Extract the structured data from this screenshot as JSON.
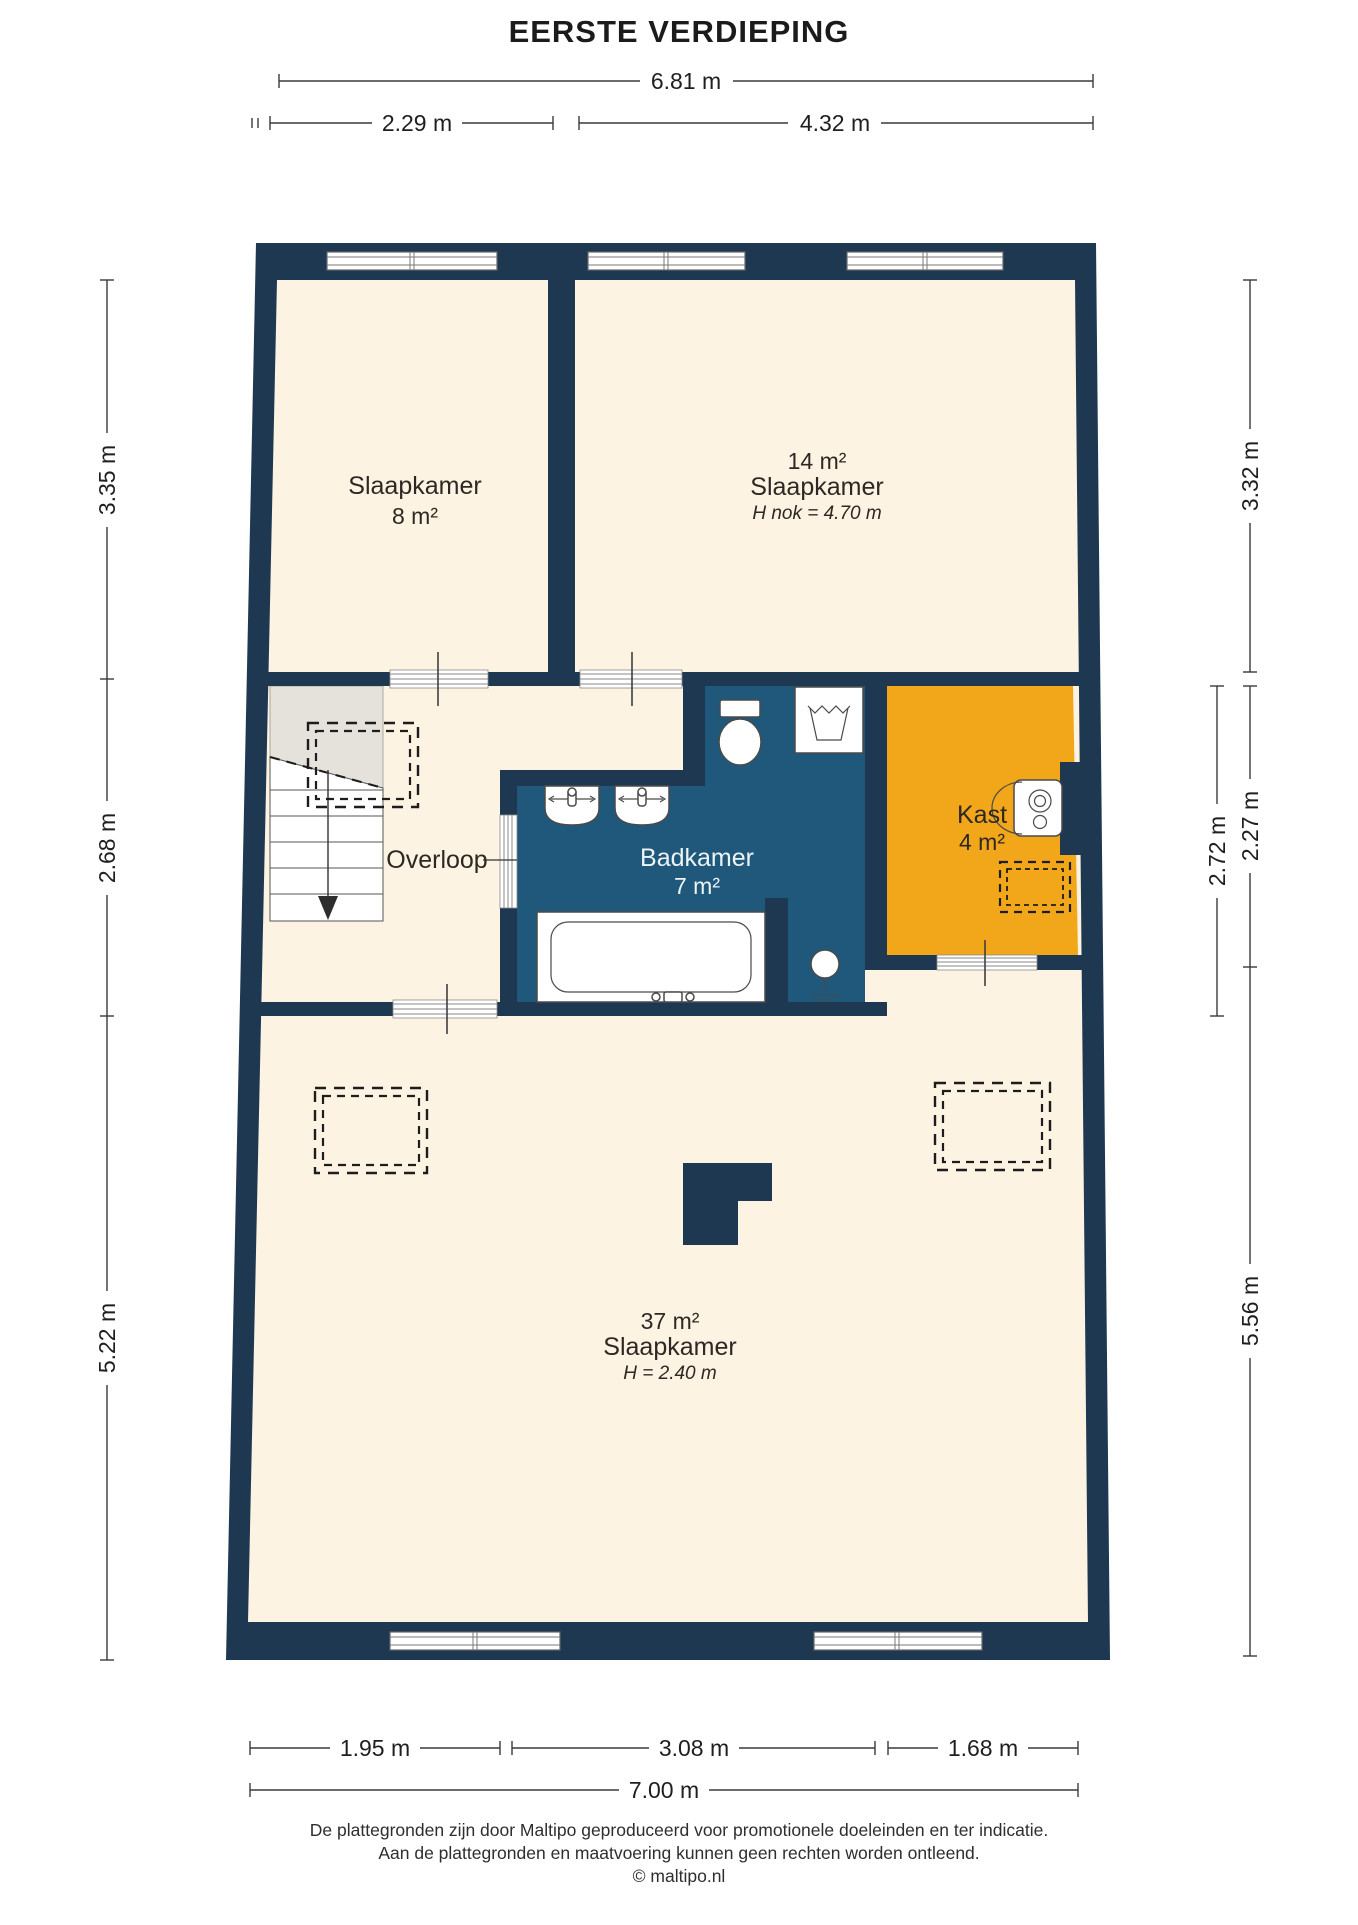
{
  "title": "EERSTE VERDIEPING",
  "rooms": {
    "slaapkamer_links": {
      "name": "Slaapkamer",
      "area": "8 m²"
    },
    "slaapkamer_rechts": {
      "area": "14 m²",
      "name": "Slaapkamer",
      "height_note": "H nok = 4.70 m"
    },
    "overloop": {
      "name": "Overloop"
    },
    "badkamer": {
      "name": "Badkamer",
      "area": "7 m²"
    },
    "kast": {
      "name": "Kast",
      "area": "4 m²"
    },
    "slaapkamer_groot": {
      "area": "37 m²",
      "name": "Slaapkamer",
      "height_note": "H = 2.40 m"
    }
  },
  "dimensions": {
    "top_total": "6.81 m",
    "top_left": "2.29 m",
    "top_right": "4.32 m",
    "left_top": "3.35 m",
    "left_middle": "2.68 m",
    "left_bottom": "5.22 m",
    "right_top": "3.32 m",
    "right_middle_outer": "2.27 m",
    "right_middle_inner": "2.72 m",
    "right_bottom": "5.56 m",
    "bottom_left": "1.95 m",
    "bottom_middle": "3.08 m",
    "bottom_right": "1.68 m",
    "bottom_total": "7.00 m"
  },
  "footer": {
    "line1": "De plattegronden zijn door Maltipo geproduceerd voor promotionele doeleinden en ter indicatie.",
    "line2": "Aan de plattegronden en maatvoering kunnen geen rechten worden ontleend.",
    "line3": "© maltipo.nl"
  },
  "colors": {
    "wall": "#1e3852",
    "room_floor": "#fdf3e2",
    "bathroom_floor": "#1f587a",
    "closet_floor": "#f2a71b",
    "stair_ceiling": "#e5e2db"
  }
}
